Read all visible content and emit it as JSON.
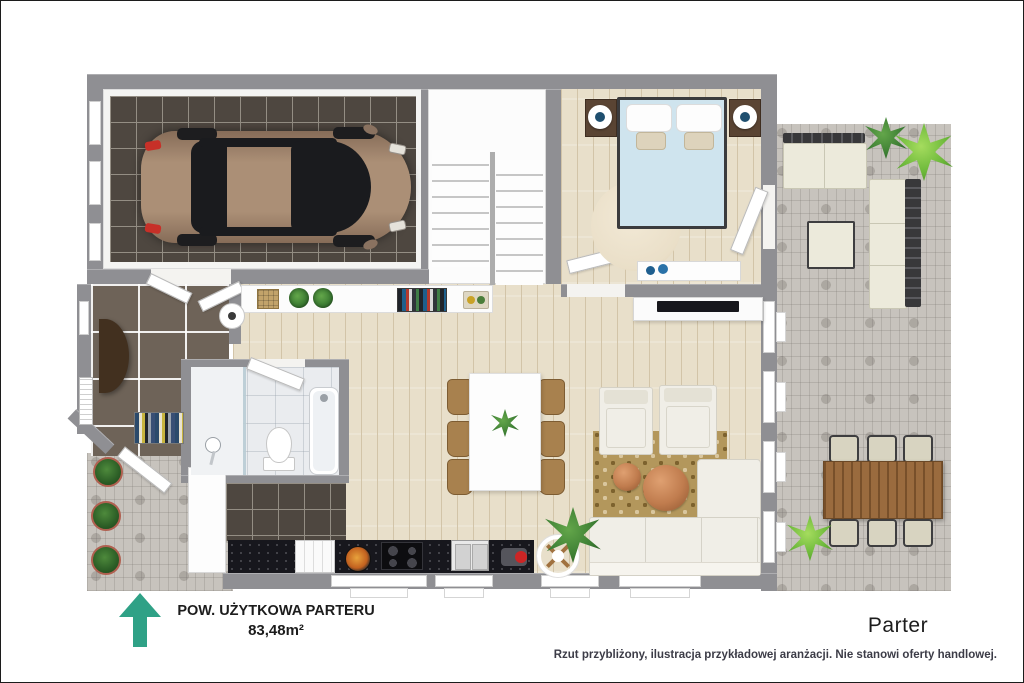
{
  "footer": {
    "area_label": "POW. UŻYTKOWA PARTERU",
    "area_value": "83,48m²",
    "floor_label": "Parter",
    "disclaimer": "Rzut przybliżony, ilustracja przykładowej aranżacji. Nie stanowi oferty handlowej."
  },
  "icons": {
    "north_arrow": "up-arrow"
  },
  "colors": {
    "arrow_green": "#2fa186",
    "wall_gray": "#8f8f93",
    "wood_floor": "#e8dfca",
    "wood_line": "#d2c4a8",
    "garage_tile": "#4e4740",
    "garage_grout": "#948e84",
    "hall_tile": "#6e6358",
    "bath_tile": "#eaecef",
    "paver_gray": "#c7c3bd",
    "counter_black": "#17171d",
    "bed_blue": "#cfe4ee",
    "car_tan": "#ab8f76",
    "rug_tan": "#b3975c",
    "bedroom_rug": "#eadfc8",
    "chair_tan": "#a8814e",
    "outdoor_wood": "#9a6b3e",
    "cushion_cream": "#eceadb",
    "sofa_white": "#f0eee7",
    "plant_green": "#3c7d33",
    "plant_bright": "#6cb83a",
    "copper": "#c07c4e",
    "tv_black": "#17171c",
    "text_dark": "#1c1c1c",
    "disclaimer_gray": "#3c3c47"
  }
}
